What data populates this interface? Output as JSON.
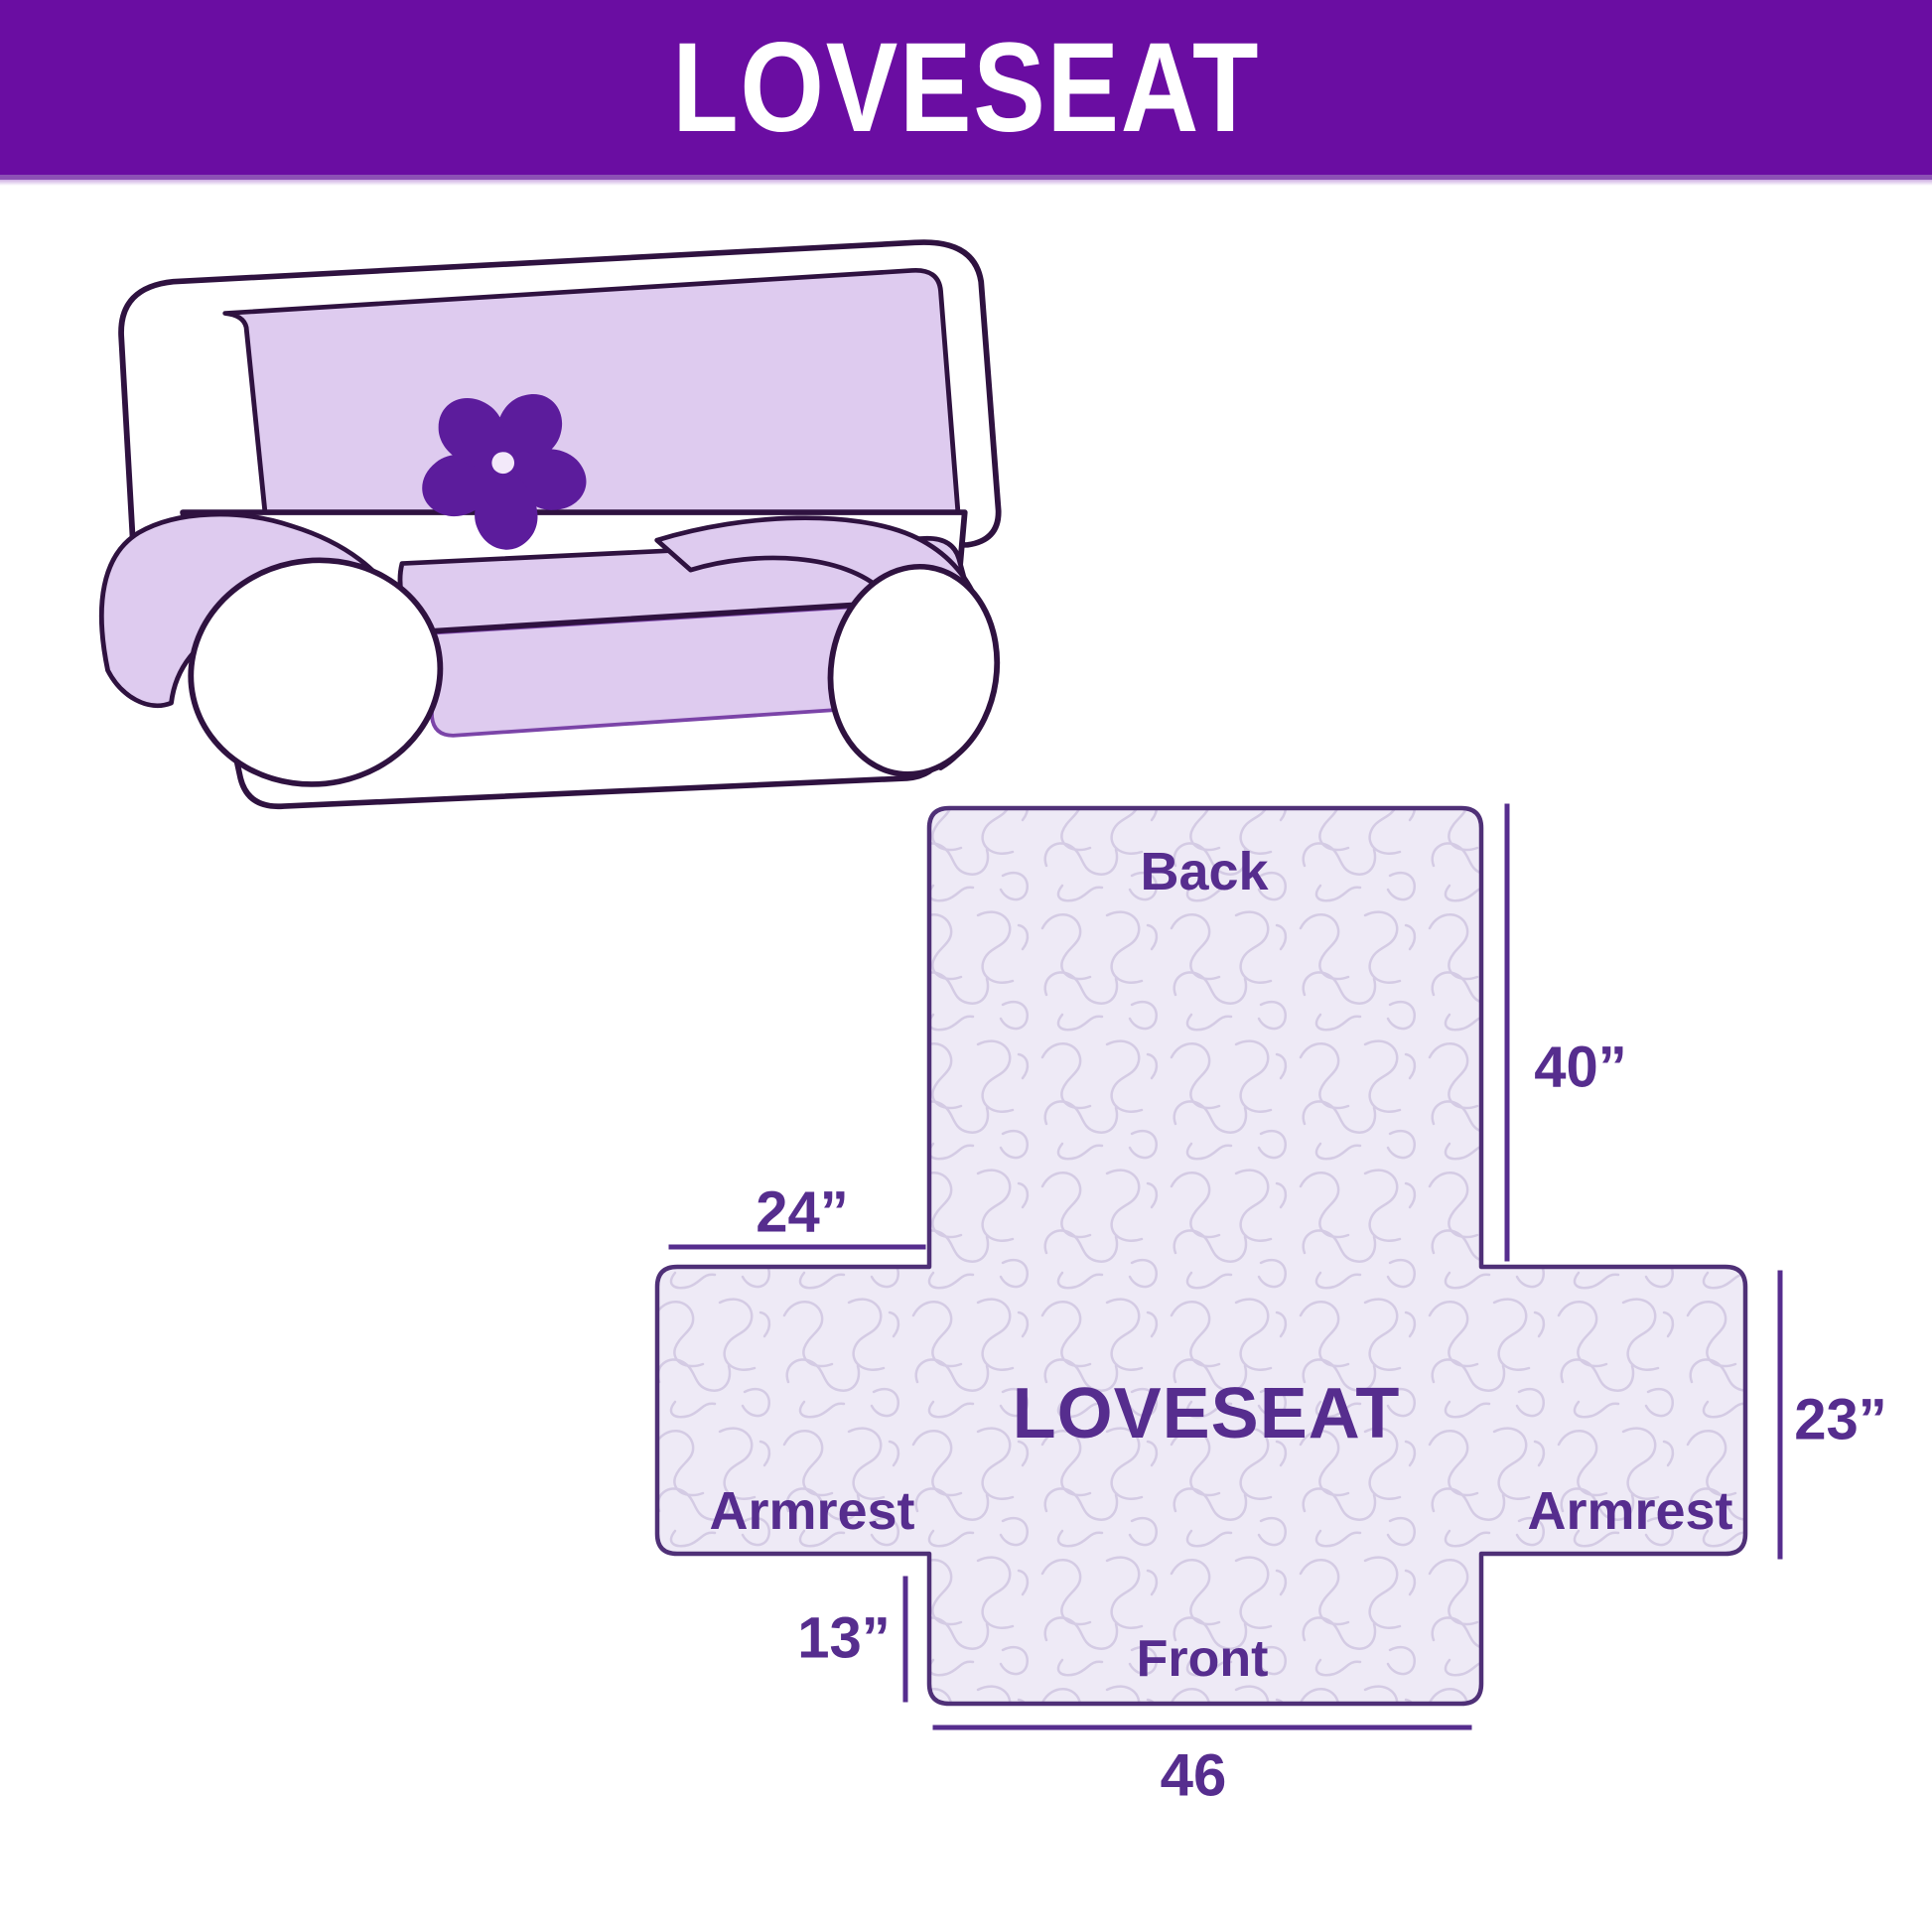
{
  "header": {
    "title": "LOVESEAT"
  },
  "illustration": {
    "description": "Loveseat sofa with light purple protective cover and pinwheel logo on the backrest",
    "logo": "pinwheel"
  },
  "diagram": {
    "center_label": "LOVESEAT",
    "back_label": "Back",
    "front_label": "Front",
    "armrest_left_label": "Armrest",
    "armrest_right_label": "Armrest",
    "dimensions": {
      "back_height": "40”",
      "armrest_flap_width": "24”",
      "side_height": "23”",
      "front_flap_height": "13”",
      "front_width": "46"
    }
  },
  "colors": {
    "header_bg": "#6A0DA2",
    "header_text": "#FFFFFF",
    "label_text": "#562D8E",
    "diagram_border": "#4F3077",
    "fabric_base": "#EEEAF6",
    "fabric_squiggle": "#D4CBE4",
    "sofa_cover": "#DECBEF",
    "sofa_outline": "#2F1240",
    "logo_purple": "#5C1C9C"
  }
}
